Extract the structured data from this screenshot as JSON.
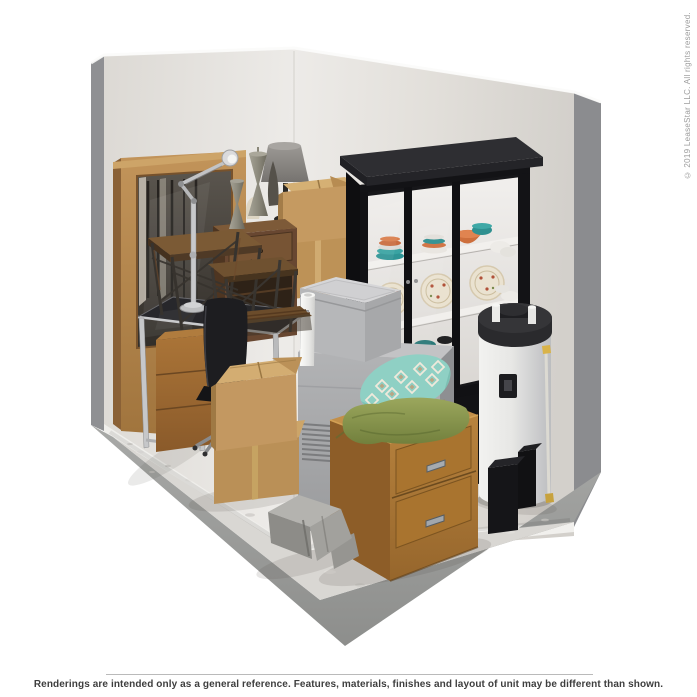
{
  "footer": {
    "disclaimer": "Renderings are intended only as a general reference. Features, materials, finishes and layout of unit may be different than shown."
  },
  "watermark": {
    "copyright": "© 2019 LeaseStar LLC. All rights reserved."
  },
  "scene": {
    "description": "3D rendering of a storage unit corner filled with household furniture and boxes",
    "palette": {
      "divider": "#bababa",
      "text-dark": "#3e3e3e",
      "text-light": "#9c9c9c",
      "wall": "#e5e2de",
      "wall-shadow": "#d3d0cb",
      "wall-edge": "#8f9093",
      "slab": "#9b9c9a",
      "floor": "#d9d7d3",
      "baseboard": "#f1f0ed",
      "oak-frame": "#b5894f",
      "walnut": "#6a4830",
      "cardboard": "#c49a62",
      "hutch-black": "#17171a",
      "shelf-white": "#efedea",
      "accent-teal": "#339a9a",
      "accent-orange": "#cd6f3c",
      "appliance-gray": "#a9aaac",
      "chest-oak": "#b5803c",
      "pillow-green": "#8c9c52",
      "pillow-teal": "#8fd4c8",
      "heater-white": "#e9e9e8",
      "chrome": "#c2c3c5"
    },
    "objects": [
      {
        "name": "framed-mirror",
        "label": "Wood-framed mirror"
      },
      {
        "name": "adjustable-desk-lamp",
        "label": "Chrome adjustable desk lamp"
      },
      {
        "name": "industrial-tables",
        "label": "Industrial nesting tables"
      },
      {
        "name": "nightstand",
        "label": "Walnut nightstand"
      },
      {
        "name": "candlestick-lamps",
        "label": "Pewter candlestick lamps"
      },
      {
        "name": "table-lamp",
        "label": "Table lamp with gray shade"
      },
      {
        "name": "box-stack-back",
        "label": "Stacked cardboard boxes"
      },
      {
        "name": "china-cabinet",
        "label": "Black china cabinet with dishes"
      },
      {
        "name": "glass-desk",
        "label": "Glass-top desk with drawer cabinet"
      },
      {
        "name": "office-chair",
        "label": "Black office chair"
      },
      {
        "name": "poster-tube",
        "label": "White rolled tube"
      },
      {
        "name": "freezer-cube",
        "label": "Small gray chest freezer"
      },
      {
        "name": "gray-appliance",
        "label": "Gray appliance with vents"
      },
      {
        "name": "box-stack-front",
        "label": "Cardboard moving boxes"
      },
      {
        "name": "water-heater",
        "label": "Water heater"
      },
      {
        "name": "speakers",
        "label": "Black speakers"
      },
      {
        "name": "two-drawer-chest",
        "label": "Oak two-drawer chest"
      },
      {
        "name": "pillow-teal-diamond",
        "label": "Teal diamond-pattern pillow"
      },
      {
        "name": "pillow-green",
        "label": "Green pillow"
      },
      {
        "name": "concrete-decor",
        "label": "Angular concrete decor piece"
      }
    ]
  }
}
